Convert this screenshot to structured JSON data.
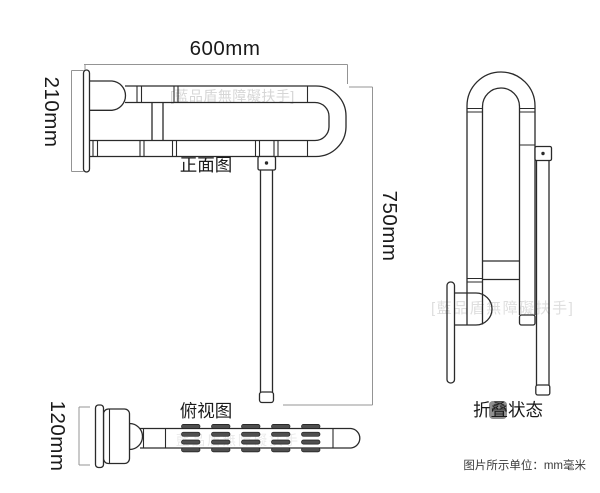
{
  "colors": {
    "background": "#ffffff",
    "outline": "#2a2a2a",
    "dimension_line": "#949494",
    "watermark": "#d6d6d6",
    "rib_fill": "#4f4f4f",
    "label_text": "#1a1a1a"
  },
  "front_view": {
    "label": "正面图",
    "dim_width": "600mm",
    "dim_arm_height": "210mm",
    "dim_total_height": "750mm",
    "watermark": "[藍品盾無障礙扶手]"
  },
  "top_view": {
    "label": "俯视图",
    "dim_depth": "120mm",
    "watermark": "藍品盾無障礙扶手"
  },
  "folded_view": {
    "label": "折叠状态",
    "watermark": "[藍品盾無障礙扶手]"
  },
  "footnote": {
    "unit_note": "图片所示单位：mm毫米"
  }
}
